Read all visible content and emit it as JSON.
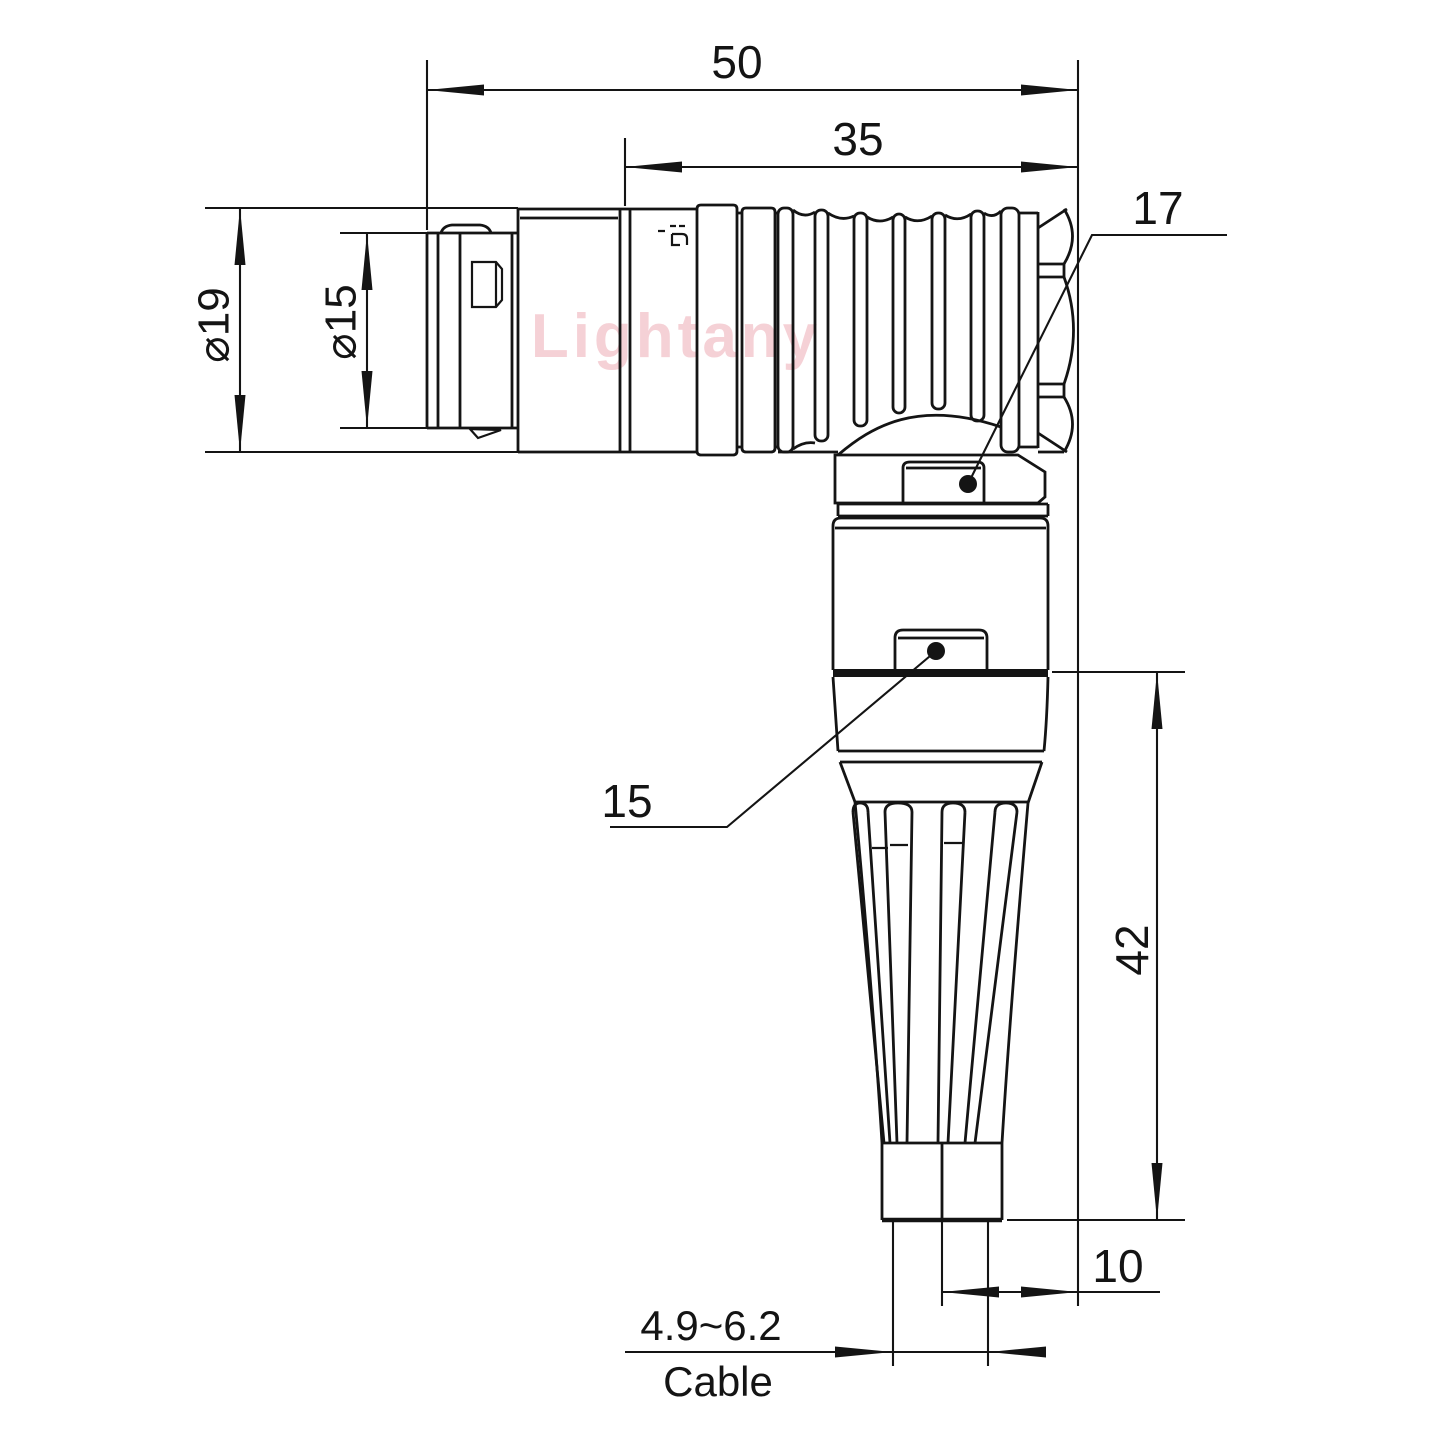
{
  "drawing": {
    "background": "#ffffff",
    "line_color": "#141414",
    "watermark": {
      "text": "Lightany",
      "color": "#f3c6cd"
    },
    "dimensions": {
      "overall_length": "50",
      "grip_length": "35",
      "nut_width": "17",
      "outer_diameter": "⌀19",
      "front_diameter": "⌀15",
      "elbow_width": "15",
      "vertical_length": "42",
      "cable_offset": "10",
      "cable_diameter_range": "4.9~6.2",
      "cable_label": "Cable"
    }
  }
}
